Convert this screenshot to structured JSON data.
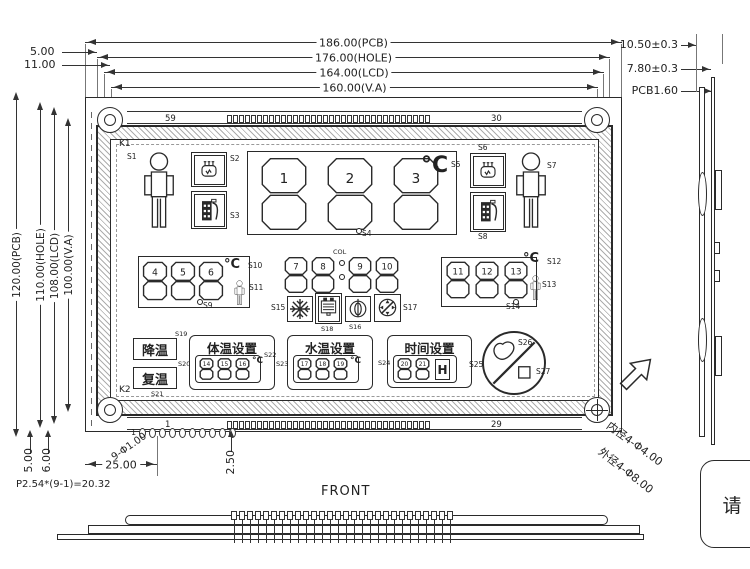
{
  "dims": {
    "top": [
      "186.00(PCB)",
      "176.00(HOLE)",
      "164.00(LCD)",
      "160.00(V.A)"
    ],
    "left_offsets": [
      "5.00",
      "11.00"
    ],
    "left_vertical": [
      "120.00(PCB)",
      "110.00(HOLE)",
      "108.00(LCD)",
      "100.00(V.A)"
    ],
    "right": [
      "10.50±0.3",
      "7.80±0.3",
      "PCB1.60"
    ],
    "bottom_left_vertical": [
      "5.00",
      "6.00"
    ],
    "bottom_pin_offset": "25.00",
    "bottom_right_vertical": "2.50",
    "pin_pitch": "P2.54*(9-1)=20.32",
    "pin_hole": "9-Φ1.00",
    "hole_inner": "内径4-Φ4.00",
    "hole_outer": "外径4-Φ8.00"
  },
  "views": {
    "front": "FRONT"
  },
  "note": "请",
  "edge": {
    "top_left_pin": "59",
    "top_right_pin": "30",
    "bottom_left_pin": "1",
    "bottom_right_pin": "29",
    "header_pin1": "1"
  },
  "keys": {
    "k1": "K1",
    "k2": "K2"
  },
  "lcd": {
    "deg_c": "°C",
    "colon": "COL",
    "hour": "H",
    "labels": {
      "cool": "降温",
      "rewarm": "复温",
      "body_temp": "体温设置",
      "water_temp": "水温设置",
      "time_set": "时间设置"
    },
    "digits": {
      "main": [
        "1",
        "2",
        "3"
      ],
      "left": [
        "4",
        "5",
        "6"
      ],
      "mid_a": [
        "7",
        "8"
      ],
      "mid_b": [
        "9",
        "10"
      ],
      "right": [
        "11",
        "12",
        "13"
      ],
      "body": [
        "14",
        "15",
        "16"
      ],
      "water": [
        "17",
        "18",
        "19"
      ],
      "time": [
        "20",
        "21"
      ]
    },
    "sensors": {
      "s1": "S1",
      "s2": "S2",
      "s3": "S3",
      "s4": "S4",
      "s5": "S5",
      "s6": "S6",
      "s7": "S7",
      "s8": "S8",
      "s9": "S9",
      "s10": "S10",
      "s11": "S11",
      "s12": "S12",
      "s13": "S13",
      "s14": "S14",
      "s15": "S15",
      "s16": "S16",
      "s17": "S17",
      "s18": "S18",
      "s19": "S19",
      "s20": "S20",
      "s21": "S21",
      "s22": "S22",
      "s23": "S23",
      "s24": "S24",
      "s25": "S25",
      "s26": "S26",
      "s27": "S27"
    }
  }
}
